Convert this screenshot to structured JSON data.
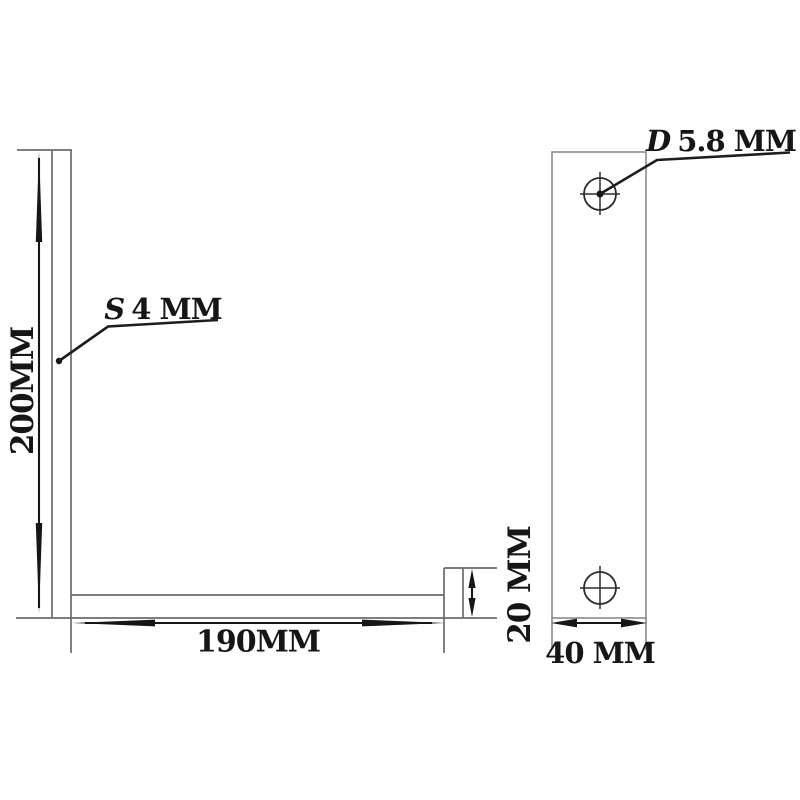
{
  "colors": {
    "background": "#ffffff",
    "part_outline": "#6b6b6b",
    "dimension": "#161616"
  },
  "labels": {
    "height": "200MM",
    "length": "190MM",
    "lip_height": "20 MM",
    "width": "40 MM",
    "thickness": {
      "prefix": "S",
      "value": "4 MM"
    },
    "hole_diameter": {
      "prefix": "D",
      "value": "5.8 MM"
    }
  }
}
